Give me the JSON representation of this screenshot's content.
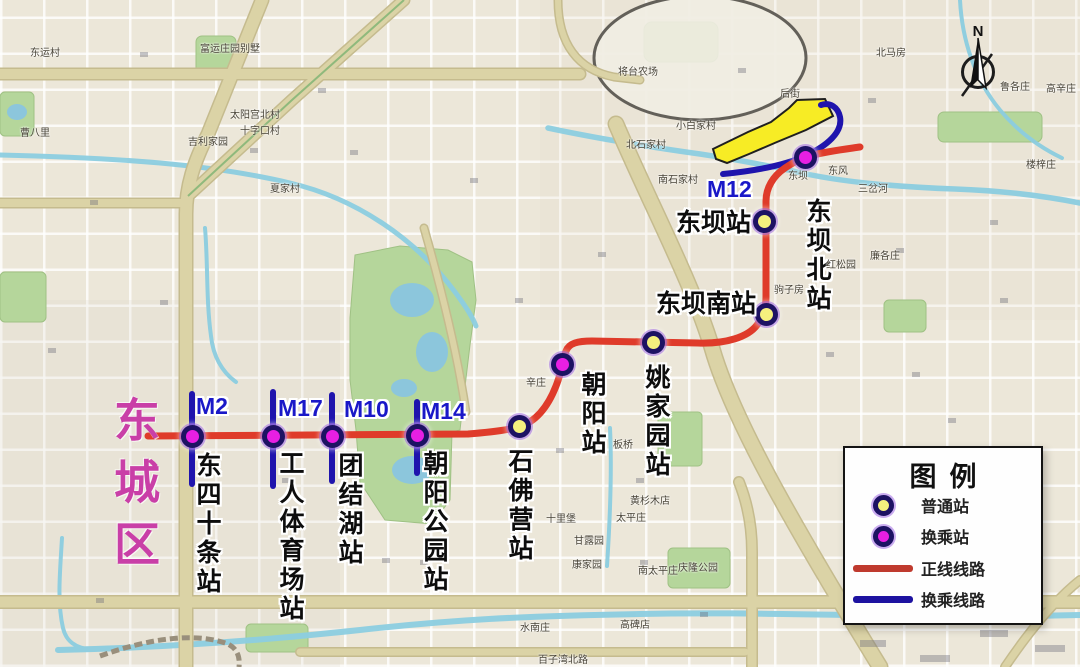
{
  "district": "东城区",
  "compass": {
    "label": "N"
  },
  "legend": {
    "title": "图例",
    "items": [
      {
        "label": "普通站",
        "type": "station-regular"
      },
      {
        "label": "换乘站",
        "type": "station-transfer"
      },
      {
        "label": "正线线路",
        "type": "line-main"
      },
      {
        "label": "换乘线路",
        "type": "line-transfer"
      }
    ]
  },
  "stations": [
    {
      "name": "东四十条站",
      "type": "transfer",
      "line_label": "M2"
    },
    {
      "name": "工人体育场站",
      "type": "transfer",
      "line_label": "M17"
    },
    {
      "name": "团结湖站",
      "type": "transfer",
      "line_label": "M10"
    },
    {
      "name": "朝阳公园站",
      "type": "transfer",
      "line_label": "M14"
    },
    {
      "name": "石佛营站",
      "type": "regular",
      "line_label": ""
    },
    {
      "name": "朝阳站",
      "type": "transfer",
      "line_label": ""
    },
    {
      "name": "姚家园站",
      "type": "regular",
      "line_label": ""
    },
    {
      "name": "东坝南站",
      "type": "regular",
      "line_label": ""
    },
    {
      "name": "东坝站",
      "type": "regular",
      "line_label": ""
    },
    {
      "name": "东坝北站",
      "type": "transfer",
      "line_label": "M12"
    }
  ],
  "colors": {
    "main_line": "#df3b2a",
    "transfer_line": "#1f14ad",
    "regular_station_fill": "#f5f07e",
    "transfer_station_fill": "#e71fe3",
    "station_ring": "#1d1263",
    "depot_fill": "#f7ec25",
    "m_label": "#1a18c8",
    "district_label": "#c93fa7"
  },
  "map_labels": [
    "东运村",
    "曹八里",
    "富运庄园别墅",
    "太阳宫北村",
    "十字口村",
    "吉利家园",
    "夏家村",
    "将台农场",
    "小白家村",
    "北石家村",
    "南石家村",
    "后街",
    "北马房",
    "鲁各庄",
    "高辛庄",
    "楼梓庄",
    "三岔河",
    "东风",
    "东坝",
    "驹子房",
    "红松园",
    "廉各庄",
    "辛庄",
    "板桥",
    "黄杉木店",
    "太平庄",
    "十里堡",
    "甘露园",
    "康家园",
    "水南庄",
    "南太平庄",
    "高碑店",
    "庆隆公园",
    "百子湾北路",
    "西柳巷"
  ]
}
